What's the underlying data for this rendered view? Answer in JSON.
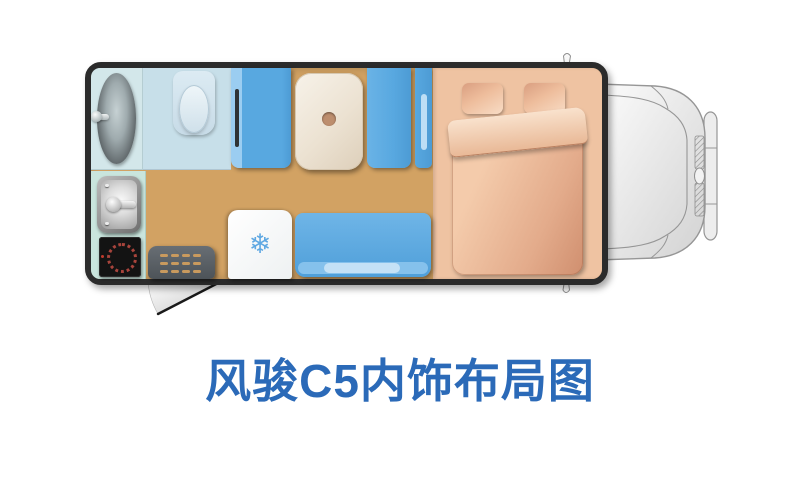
{
  "title": {
    "text": "风骏C5内饰布局图",
    "color": "#2b6ab8"
  },
  "floorplan": {
    "icons": {
      "snowflake": "❄"
    },
    "colors": {
      "floor": "#d2a263",
      "body_outline": "#2b2b2b",
      "shower_room": "#d3e7ea",
      "toilet_room": "#c7dfe9",
      "kitchen": "#c9e5dd",
      "seat_blue": "#58a8e0",
      "table_cream": "#ece2d2",
      "bed_salmon": "#efc3a2",
      "fridge_white": "#ffffff",
      "step_mat": "#565c61",
      "mat_dash": "#c99a5e",
      "burner_ring": "#a8443c",
      "snowflake_blue": "#5fa8e2",
      "cab_outline": "#969696",
      "title_blue": "#2b6ab8"
    },
    "items": [
      "shower-tub",
      "toilet",
      "wardrobe",
      "dinette-table",
      "seat",
      "seat",
      "double-bed",
      "pillows",
      "duvet",
      "sink",
      "stove",
      "entry-step-mat",
      "fridge",
      "sofa-bench",
      "entry-door-swing",
      "truck-cab"
    ]
  }
}
